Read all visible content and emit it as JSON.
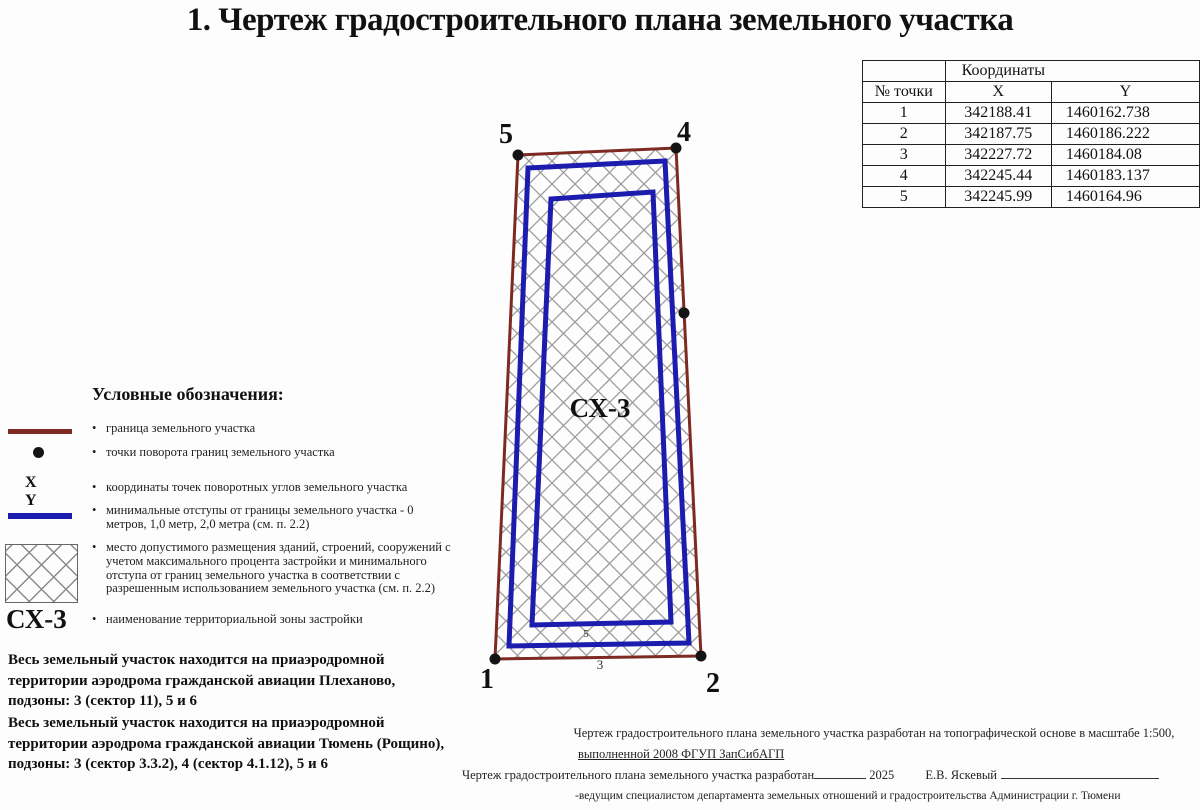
{
  "title": "1. Чертеж градостроительного плана земельного участка",
  "coords_table": {
    "group_header": "Координаты",
    "col_point": "№ точки",
    "col_x": "X",
    "col_y": "Y",
    "rows": [
      {
        "n": "1",
        "x": "342188.41",
        "y": "1460162.738"
      },
      {
        "n": "2",
        "x": "342187.75",
        "y": "1460186.222"
      },
      {
        "n": "3",
        "x": "342227.72",
        "y": "1460184.08"
      },
      {
        "n": "4",
        "x": "342245.44",
        "y": "1460183.137"
      },
      {
        "n": "5",
        "x": "342245.99",
        "y": "1460164.96"
      }
    ]
  },
  "plot": {
    "zone_label": "СХ-3",
    "labels": {
      "p1": "1",
      "p2": "2",
      "p4": "4",
      "p5": "5"
    },
    "dim_labels": {
      "inner": "5",
      "outer": "3"
    },
    "colors": {
      "boundary": "#7d2b22",
      "offset_line": "#1c1cae",
      "hatch": "#9b9b9b",
      "point_dot": "#141414"
    }
  },
  "legend": {
    "heading": "Условные обозначения:",
    "items": [
      {
        "symbol": "boundary-line",
        "text": "граница земельного участка"
      },
      {
        "symbol": "turn-point-dot",
        "text": "точки поворота границ земельного участка"
      },
      {
        "symbol": "xy-coordinates",
        "x_label": "X",
        "y_label": "Y",
        "text": "координаты точек поворотных углов земельного участка"
      },
      {
        "symbol": "offset-line",
        "text": "минимальные отступы от границы земельного участка - 0 метров, 1,0 метр, 2,0 метра (см. п. 2.2)"
      },
      {
        "symbol": "hatch-area",
        "text": "место допустимого размещения зданий, строений, сооружений с учетом максимального процента застройки и минимального отступа от границ земельного участка в соответствии с разрешенным использованием земельного участка (см. п. 2.2)"
      },
      {
        "symbol": "zone-name",
        "zone_label": "СХ-3",
        "text": "наименование территориальной зоны застройки"
      }
    ]
  },
  "notes": [
    "Весь земельный участок находится на приаэродромной территории аэродрома гражданской авиации Плеханово, подзоны: 3 (сектор 11), 5 и 6",
    "Весь земельный участок находится на приаэродромной территории аэродрома гражданской авиации Тюмень (Рощино), подзоны: 3 (сектор 3.3.2), 4 (сектор 4.1.12), 5 и 6"
  ],
  "footer": {
    "line1": "Чертеж градостроительного плана земельного участка разработан на топографической основе в масштабе 1:500,",
    "line2": "выполненной 2008 ФГУП ЗапСибАГП",
    "line3_prefix": "Чертеж градостроительного плана земельного участка разработан",
    "line3_year": "2025",
    "line3_name": "Е.В. Яскевый",
    "line4": "-ведущим специалистом департамента земельных отношений и градостроительства Администрации г. Тюмени"
  }
}
